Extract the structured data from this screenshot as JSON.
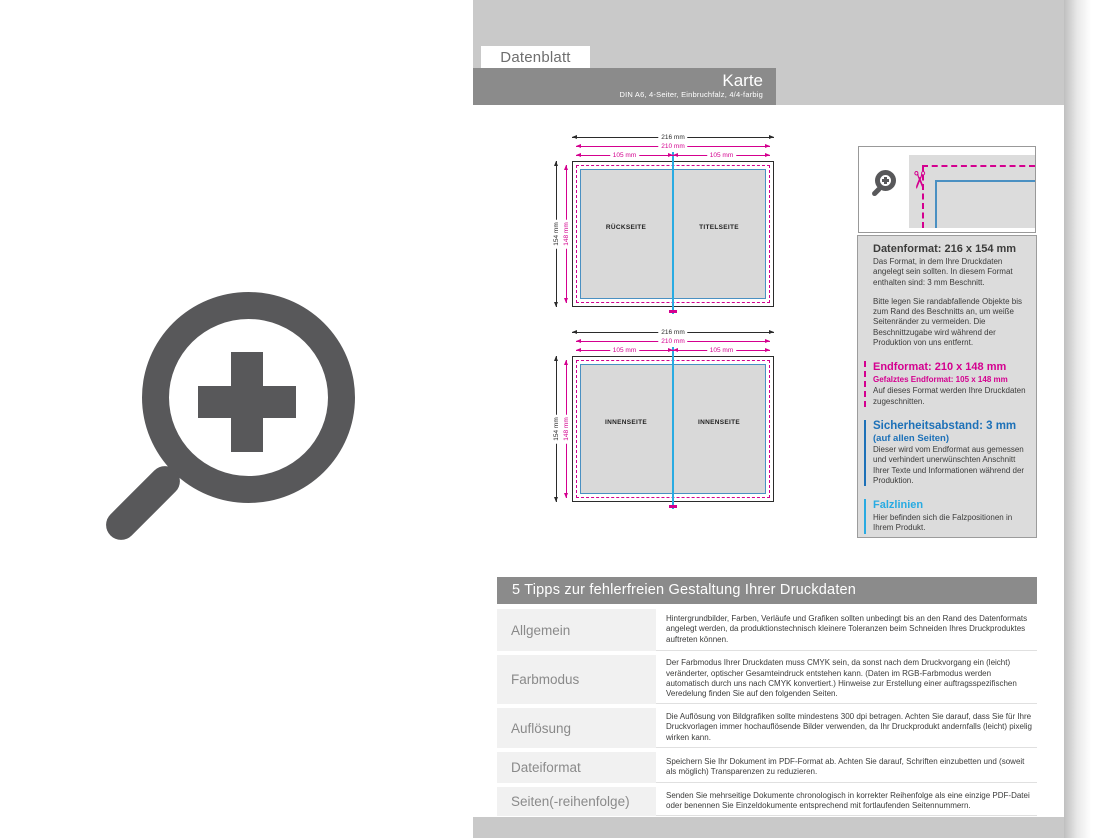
{
  "header": {
    "tab_label": "Datenblatt",
    "title": "Karte",
    "subtitle": "DIN A6, 4-Seiter, Einbruchfalz, 4/4-farbig"
  },
  "icons": {
    "zoom_large": "magnifier-plus",
    "zoom_small": "magnifier-plus",
    "scissors": "scissors",
    "scissors_glyph": "✂"
  },
  "diagrams": [
    {
      "width_total": "216 mm",
      "width_trim": "210 mm",
      "width_left": "105 mm",
      "width_right": "105 mm",
      "height_total": "154 mm",
      "height_trim": "148 mm",
      "panel_left": "RÜCKSEITE",
      "panel_right": "TITELSEITE"
    },
    {
      "width_total": "216 mm",
      "width_trim": "210 mm",
      "width_left": "105 mm",
      "width_right": "105 mm",
      "height_total": "154 mm",
      "height_trim": "148 mm",
      "panel_left": "INNENSEITE",
      "panel_right": "INNENSEITE"
    }
  ],
  "info_panel": {
    "sections": [
      {
        "heading": "Datenformat: 216 x 154 mm",
        "p1": "Das Format, in dem Ihre Druckdaten angelegt sein sollten. In diesem Format enthalten sind: 3 mm Beschnitt.",
        "p2": "Bitte legen Sie randabfallende Objekte bis zum Rand des Beschnitts an, um weiße Seitenränder zu vermeiden. Die Beschnittzugabe wird während der Produktion von uns entfernt."
      },
      {
        "heading": "Endformat: 210 x 148 mm",
        "subheading": "Gefalztes Endformat: 105 x 148 mm",
        "p1": "Auf dieses Format werden Ihre Druckdaten zugeschnitten."
      },
      {
        "heading": "Sicherheitsabstand: 3 mm",
        "subheading": "(auf allen Seiten)",
        "p1": "Dieser wird vom Endformat aus gemessen und verhindert unerwünschten Anschnitt Ihrer Texte und Informationen während der Produktion."
      },
      {
        "heading": "Falzlinien",
        "p1": "Hier befinden sich die Falzpositionen in Ihrem Produkt."
      }
    ]
  },
  "tips": {
    "title": "5 Tipps zur fehlerfreien Gestaltung Ihrer Druckdaten",
    "rows": [
      {
        "label": "Allgemein",
        "text": "Hintergrundbilder, Farben, Verläufe und Grafiken sollten unbedingt bis an den Rand des Datenformats angelegt werden, da produktionstechnisch kleinere Toleranzen beim Schneiden Ihres Druckproduktes auftreten können."
      },
      {
        "label": "Farbmodus",
        "text": "Der Farbmodus Ihrer Druckdaten muss CMYK sein, da sonst nach dem Druckvorgang ein (leicht) veränderter, optischer Gesamteindruck entstehen kann. (Daten im RGB-Farbmodus werden automatisch durch uns nach CMYK konvertiert.) Hinweise zur Erstellung einer auftragsspezifischen Veredelung finden Sie auf den folgenden Seiten."
      },
      {
        "label": "Auflösung",
        "text": "Die Auflösung von Bildgrafiken sollte mindestens 300 dpi betragen. Achten Sie darauf, dass Sie für Ihre Druckvorlagen immer hochauflösende Bilder verwenden, da Ihr Druckprodukt andernfalls (leicht) pixelig wirken kann."
      },
      {
        "label": "Dateiformat",
        "text": "Speichern Sie Ihr Dokument im PDF-Format ab. Achten Sie darauf, Schriften einzubetten und (soweit als möglich) Transparenzen zu reduzieren."
      },
      {
        "label": "Seiten(-reihenfolge)",
        "text": "Senden Sie mehrseitige Dokumente chronologisch in korrekter Reihenfolge als eine einzige PDF-Datei oder benennen Sie Einzeldokumente entsprechend mit fortlaufenden Seitennummern."
      }
    ]
  },
  "colors": {
    "accent_magenta": "#d4008f",
    "accent_blue": "#1d71b8",
    "accent_cyan": "#29abe2",
    "safety_rect_blue": "#4a90c2",
    "band_light_gray": "#c9c9c9",
    "band_dark_gray": "#8b8b8b",
    "panel_gray": "#dcdcdc",
    "icon_gray": "#58585a"
  }
}
